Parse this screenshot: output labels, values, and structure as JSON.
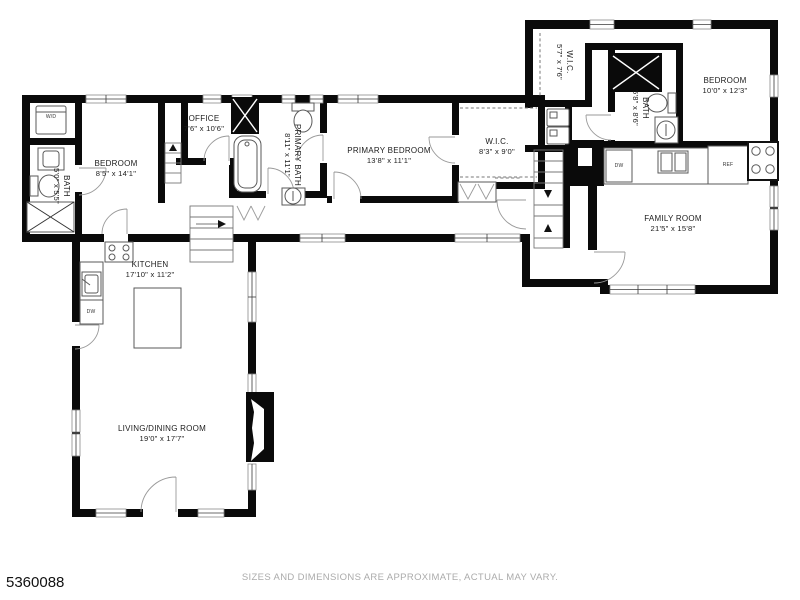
{
  "page": {
    "listing_id": "5360088",
    "disclaimer": "SIZES AND DIMENSIONS ARE APPROXIMATE, ACTUAL MAY VARY."
  },
  "colors": {
    "wall": "#0a0a0a",
    "fixture_line": "#5a5a5a",
    "label_text": "#1c1c1c",
    "disclaimer_text": "#ababab"
  },
  "rooms": [
    {
      "id": "bedroom-west",
      "name": "BEDROOM",
      "dims": "8'5\" x 14'1\"",
      "orientation": "horizontal"
    },
    {
      "id": "bath-west",
      "name": "BATH",
      "dims": "5'0\" x 5'5\"",
      "orientation": "vertical"
    },
    {
      "id": "office",
      "name": "OFFICE",
      "dims": "7'6\" x 10'6\"",
      "orientation": "horizontal"
    },
    {
      "id": "primary-bath",
      "name": "PRIMARY BATH",
      "dims": "8'11\" x 11'1\"",
      "orientation": "vertical"
    },
    {
      "id": "primary-bedroom",
      "name": "PRIMARY BEDROOM",
      "dims": "13'8\" x 11'1\"",
      "orientation": "horizontal"
    },
    {
      "id": "wic-primary",
      "name": "W.I.C.",
      "dims": "8'3\" x 9'0\"",
      "orientation": "horizontal"
    },
    {
      "id": "wic-upper",
      "name": "W.I.C.",
      "dims": "5'7\" x 7'6\"",
      "orientation": "vertical"
    },
    {
      "id": "bath-upper",
      "name": "BATH",
      "dims": "5'8\" x 8'6\"",
      "orientation": "vertical"
    },
    {
      "id": "bedroom-upper",
      "name": "BEDROOM",
      "dims": "10'0\" x 12'3\"",
      "orientation": "horizontal"
    },
    {
      "id": "family-room",
      "name": "FAMILY ROOM",
      "dims": "21'5\" x 15'8\"",
      "orientation": "horizontal"
    },
    {
      "id": "kitchen",
      "name": "KITCHEN",
      "dims": "17'10\" x 11'2\"",
      "orientation": "horizontal"
    },
    {
      "id": "living-dining",
      "name": "LIVING/DINING ROOM",
      "dims": "19'0\" x 17'7\"",
      "orientation": "horizontal"
    }
  ],
  "fixtures": {
    "washer_dryer": "W/D",
    "dishwasher": "DW",
    "refrigerator": "REF"
  }
}
